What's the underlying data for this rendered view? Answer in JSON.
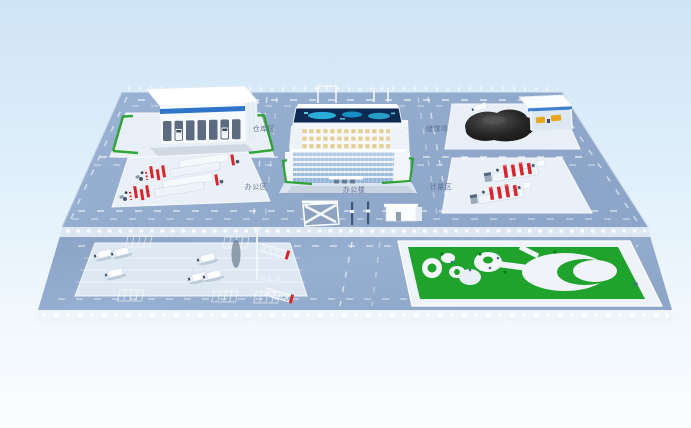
{
  "scene": {
    "kind": "isometric-3d-site-plan-render",
    "description": "3D rendering of an industrial campus: warehouse, office building with LED screen, coal yard with canopy, two equipment pads, entrance gate, truck parking lot with lattice towers, landscaped park"
  },
  "labels": {
    "warehouse_zone": "仓库区",
    "coal_yard": "储煤场",
    "office_zone": "办公区",
    "office_building": "办公楼",
    "weighing_zone": "计量区",
    "parking_lot": "停车场"
  },
  "colors": {
    "sky_top": "#cfe4f5",
    "sky_bottom": "#fbfdff",
    "platform_blue": "#93abcc",
    "platform_face": "#dce7f3",
    "pad_white": "#e9eff7",
    "road_marking": "#ffffff",
    "hedge_green": "#27a02b",
    "lawn_green": "#1fa32c",
    "coal_black": "#1c1c1c",
    "equipment_red": "#d8242a",
    "glass_blue": "#9fbddd",
    "screen_navy": "#0d2a52",
    "screen_cyan": "#2fc3ee",
    "blue_stripe": "#2e74c8",
    "machine_yellow": "#e8a51e"
  },
  "features": {
    "warehouse": {
      "bays": 7,
      "trucks_in_bays": 2
    },
    "office_building": {
      "glass_floors": 6,
      "penthouse_window_rows": 3,
      "led_screen": true
    },
    "coal_yard": {
      "coal_piles": 1,
      "canopy": true,
      "loaders": 2,
      "trucks": 1
    },
    "equipment_pads": {
      "count": 2,
      "rows_each": 2
    },
    "parking_lot": {
      "trucks": 6,
      "stall_groups": 5,
      "light_poles": 1
    },
    "lattice_towers": {
      "count": 2
    },
    "park": {
      "oval_plaza": true,
      "path_loops": 3
    }
  }
}
